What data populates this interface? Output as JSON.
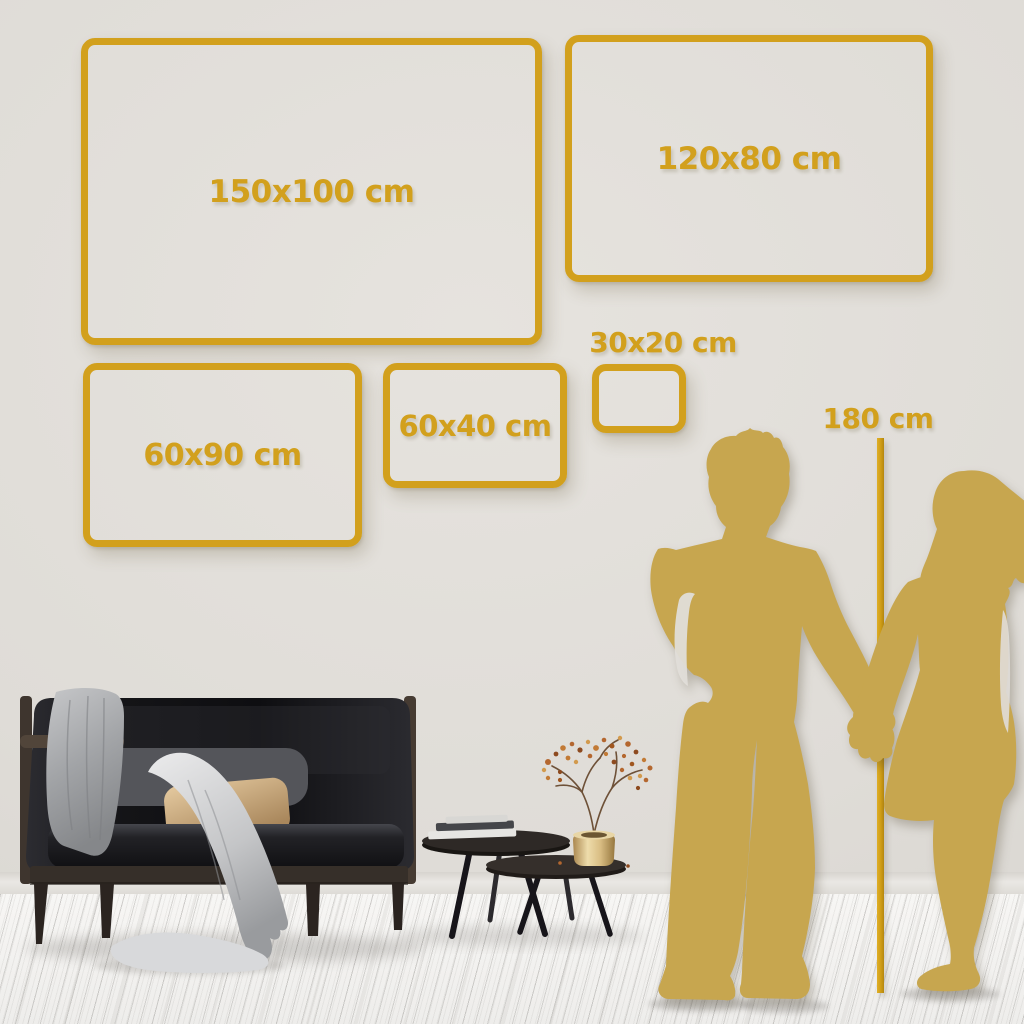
{
  "sizes": {
    "frames": [
      {
        "id": "150x100",
        "label": "150x100 cm"
      },
      {
        "id": "120x80",
        "label": "120x80 cm"
      },
      {
        "id": "60x90",
        "label": "60x90 cm"
      },
      {
        "id": "60x40",
        "label": "60x40 cm"
      },
      {
        "id": "30x20",
        "label": "30x20 cm"
      }
    ],
    "height_reference": {
      "label": "180 cm"
    }
  },
  "colors": {
    "accent_gold": "#d2a01d",
    "silhouette_gold": "#c7a64f",
    "wall": "#e0ddd8",
    "floor": "#f3f2f0"
  }
}
